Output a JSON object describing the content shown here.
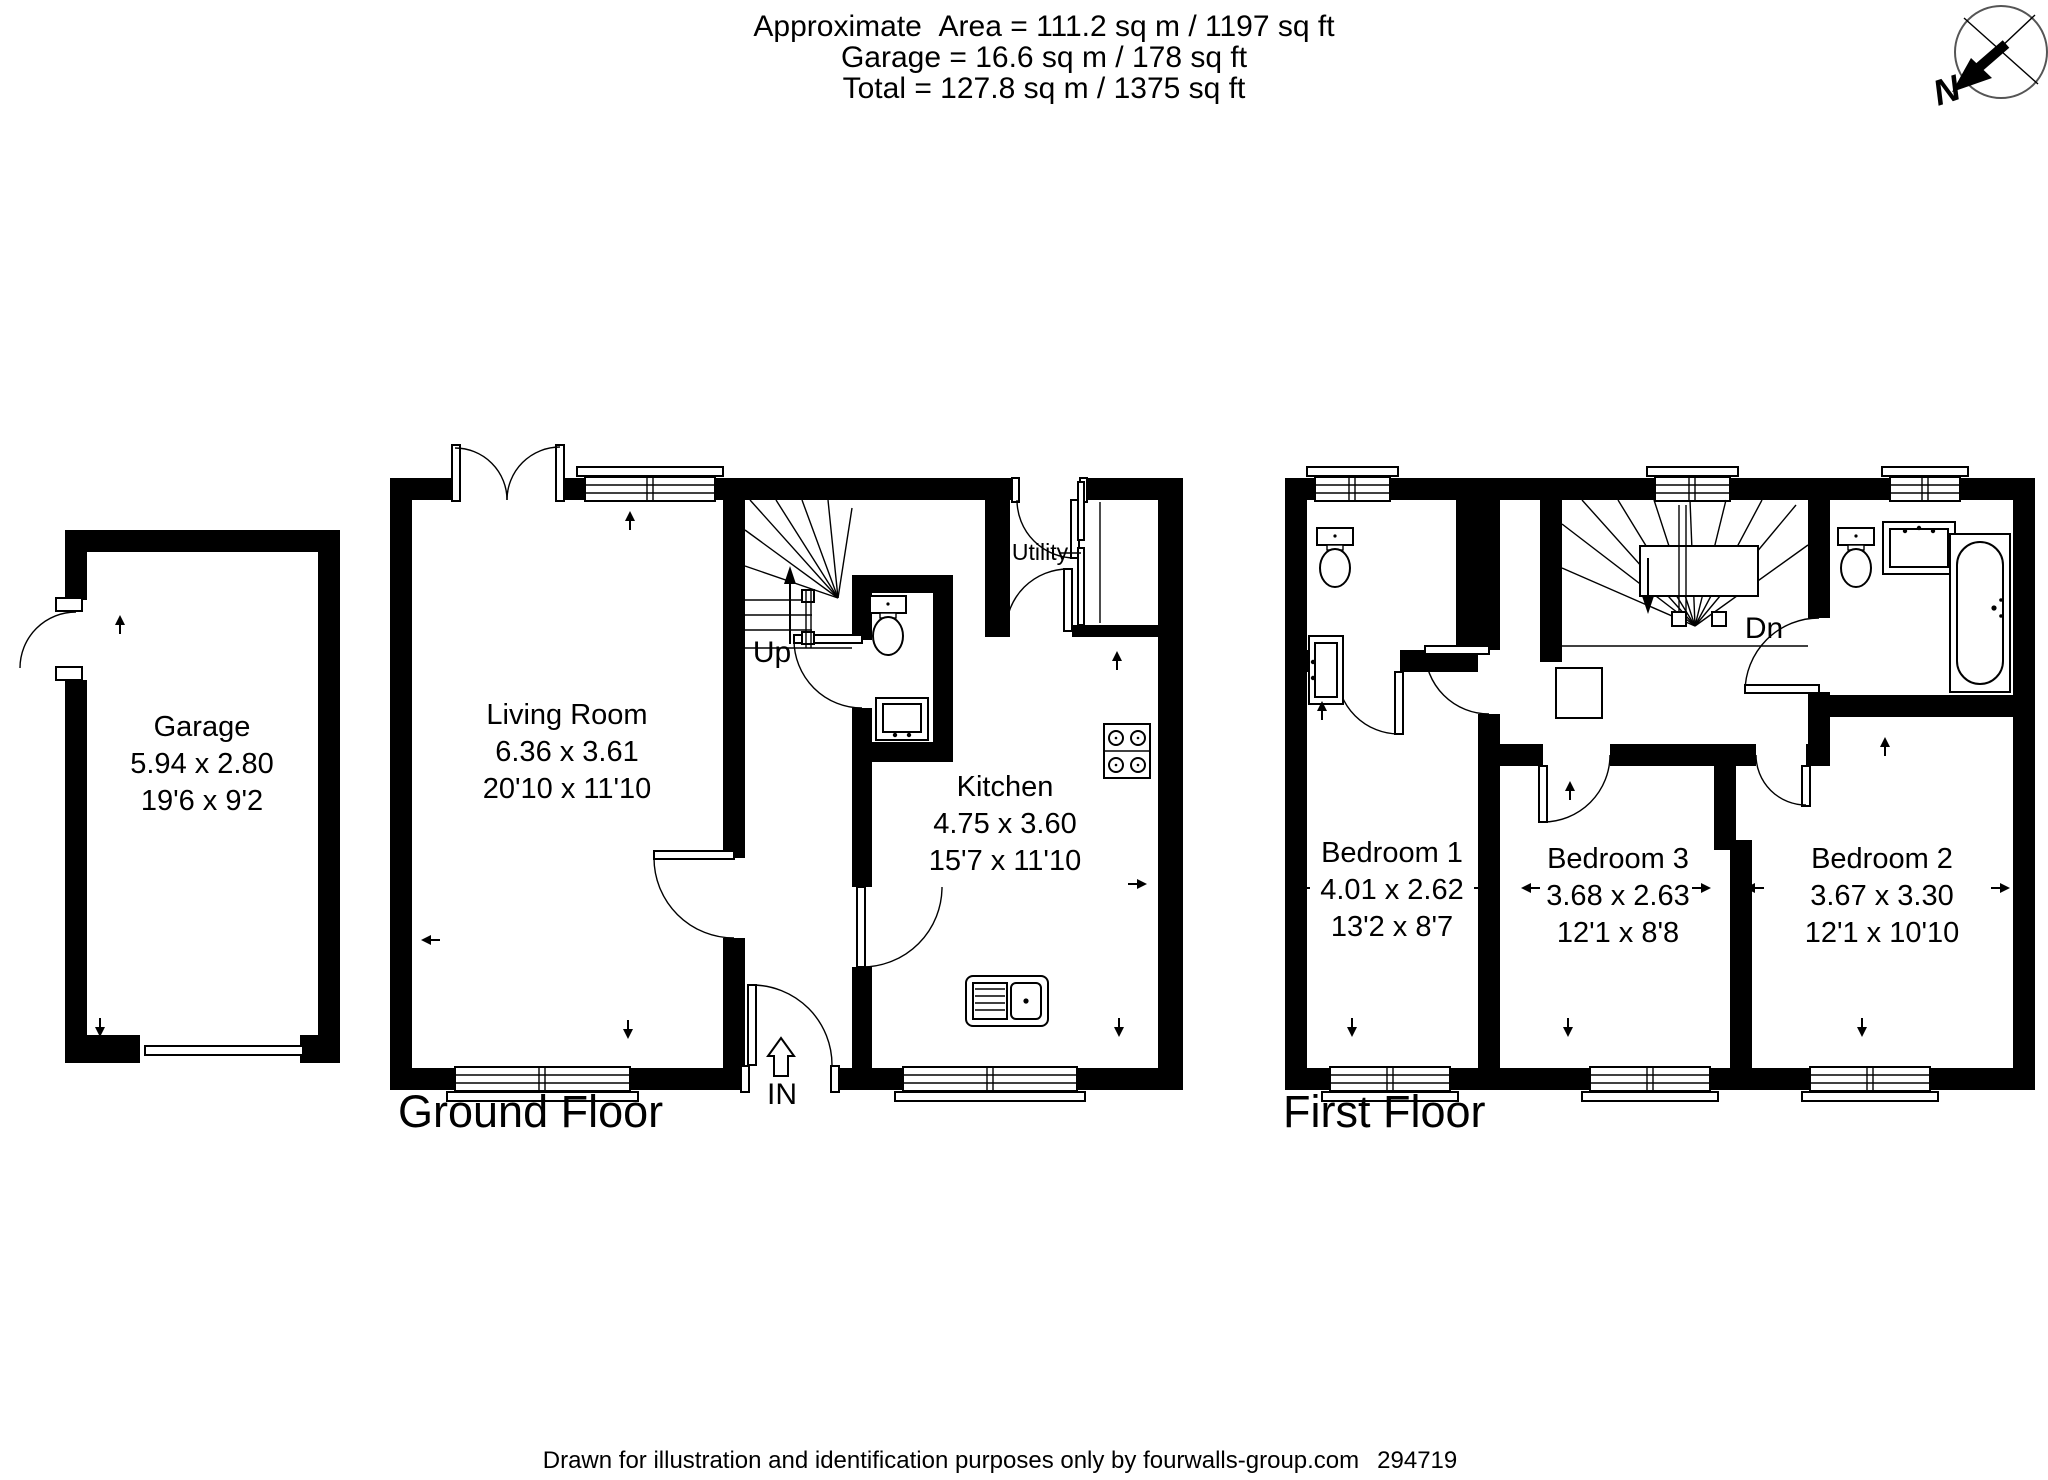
{
  "colors": {
    "ink": "#000000",
    "background": "#ffffff",
    "compass_ring": "#555555"
  },
  "header": {
    "area_line": "Approximate  Area = 111.2 sq m / 1197 sq ft",
    "garage_line": "Garage = 16.6 sq m / 178 sq ft",
    "total_line": "Total = 127.8 sq m / 1375 sq ft"
  },
  "compass": {
    "north_label": "N"
  },
  "garage": {
    "name": "Garage",
    "size_metric": "5.94 x 2.80",
    "size_imperial": "19'6 x 9'2"
  },
  "ground_floor": {
    "title": "Ground Floor",
    "labels": {
      "stairs": "Up",
      "entrance": "IN"
    },
    "rooms": {
      "living_room": {
        "name": "Living Room",
        "size_metric": "6.36 x 3.61",
        "size_imperial": "20'10 x 11'10"
      },
      "kitchen": {
        "name": "Kitchen",
        "size_metric": "4.75 x 3.60",
        "size_imperial": "15'7 x 11'10"
      },
      "utility": {
        "name": "Utility"
      }
    }
  },
  "first_floor": {
    "title": "First Floor",
    "labels": {
      "stairs": "Dn"
    },
    "rooms": {
      "bedroom_1": {
        "name": "Bedroom 1",
        "size_metric": "4.01 x 2.62",
        "size_imperial": "13'2 x 8'7"
      },
      "bedroom_3": {
        "name": "Bedroom 3",
        "size_metric": "3.68 x 2.63",
        "size_imperial": "12'1 x 8'8"
      },
      "bedroom_2": {
        "name": "Bedroom 2",
        "size_metric": "3.67 x 3.30",
        "size_imperial": "12'1 x 10'10"
      }
    }
  },
  "footer": {
    "disclaimer": "Drawn for illustration and identification purposes only by fourwalls-group.com",
    "reference": "294719"
  }
}
